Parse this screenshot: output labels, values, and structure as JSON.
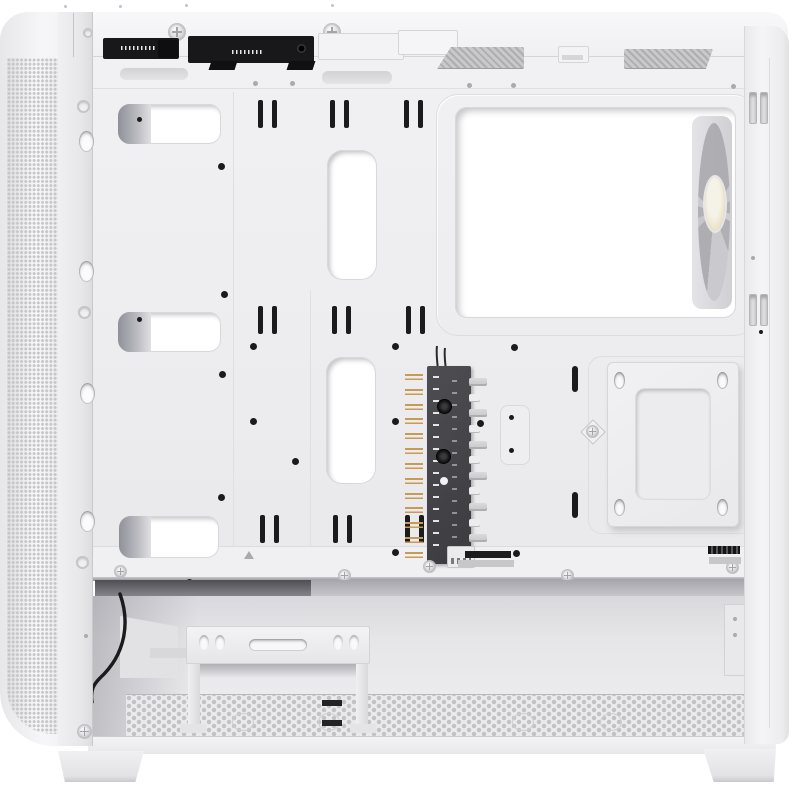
{
  "scene": {
    "subject": "White mid-tower PC computer case, side panel removed, interior view of motherboard tray rear",
    "elements": {
      "front_panel": "perforated mesh intake panel",
      "top_io": "front I/O connector modules seen from inside",
      "cpu_window": "large CPU cooler cutout with rear exhaust fan visible",
      "fan_hub": "vertical ARGB/PWM fan hub PCB with headers",
      "ssd_mount": "2.5-inch SSD mounting plate with oval slots",
      "hdd_cage": "white HDD cage bracket in PSU chamber",
      "floor": "perforated dust-filter floor mesh",
      "feet": "two trapezoid case feet"
    }
  },
  "colors": {
    "bg": "#ffffff",
    "shell": "#f3f3f5",
    "shellMid": "#ececee",
    "tray": "#eeeef0",
    "seam": "#d7d7db",
    "line": "#c9c9cd",
    "dark": "#1b1b1d",
    "pcb": "#46464a",
    "gold": "#c79a56",
    "blade": "#b4b4b8",
    "cream": "#eae2c8",
    "meshDot": "#c6c6ca",
    "floorDot": "#c2c2c6",
    "shadowDeep": "#9a9aa0",
    "white": "#ffffff"
  },
  "components": {
    "pcb_pin_rows": 13,
    "pcb_connector_rows": 12
  }
}
